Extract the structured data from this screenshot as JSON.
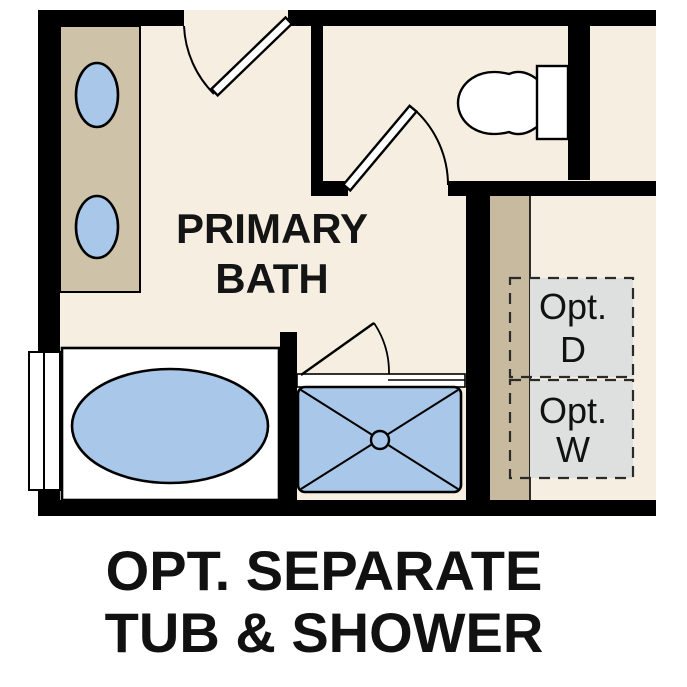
{
  "plan": {
    "room_label": {
      "line1": "PRIMARY",
      "line2": "BATH"
    },
    "optional_dryer": {
      "line1": "Opt.",
      "line2": "D"
    },
    "optional_washer": {
      "line1": "Opt.",
      "line2": "W"
    }
  },
  "caption": {
    "line1": "OPT. SEPARATE",
    "line2": "TUB & SHOWER"
  },
  "fixtures": [
    "double-sink-vanity",
    "toilet",
    "bathtub",
    "shower-pan",
    "window",
    "entry-door-swing",
    "wc-door-swing",
    "shower-door-swing",
    "cabinet-run"
  ],
  "colors": {
    "background": "#ffffff",
    "floor": "#f5eee1",
    "wall": "#000000",
    "vanity": "#cec3a9",
    "cabinet_run": "#c7ba9e",
    "fixture_blue": "#a9c7e8",
    "fixture_white": "#ffffff",
    "appliance_box": "#dee0e0",
    "text": "#111111"
  }
}
